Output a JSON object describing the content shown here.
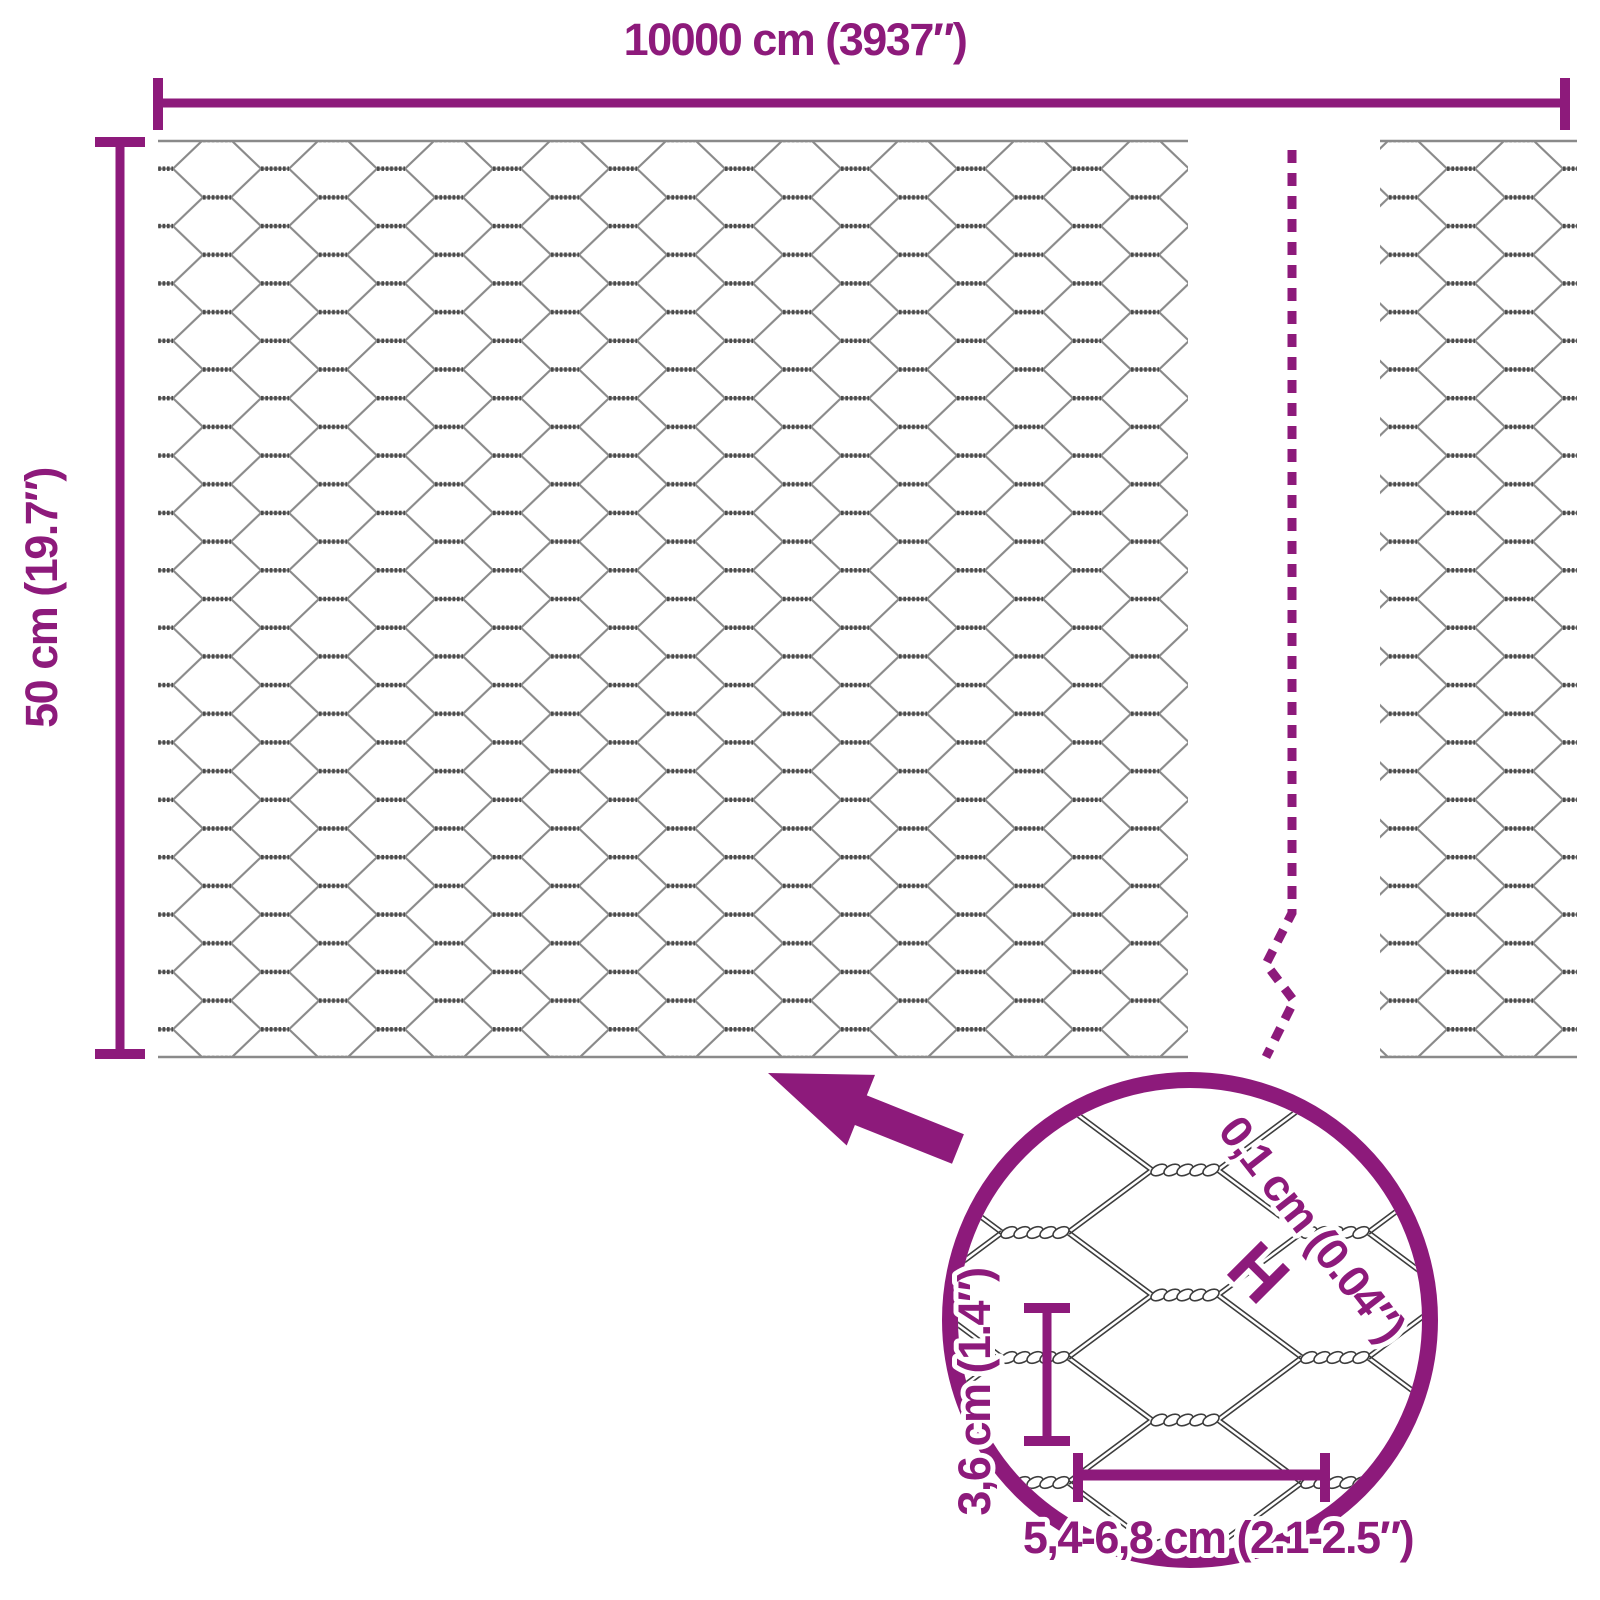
{
  "product": "hexagonal wire netting roll dimension diagram",
  "labels": {
    "total_width": "10000 cm (3937″)",
    "roll_height": "50 cm (19.7″)",
    "wire_thickness": "0,1 cm (0.04″)",
    "wire_thickness_marker": "H",
    "mesh_height": "3,6 cm (1.4″)",
    "mesh_width": "5,4-6,8 cm (2.1-2.5″)"
  },
  "colors": {
    "accent": "#8D1A7B",
    "wire": "#8A8A8A",
    "wire_dark": "#4B4B4B",
    "detail_wire": "#3D3D3D"
  }
}
